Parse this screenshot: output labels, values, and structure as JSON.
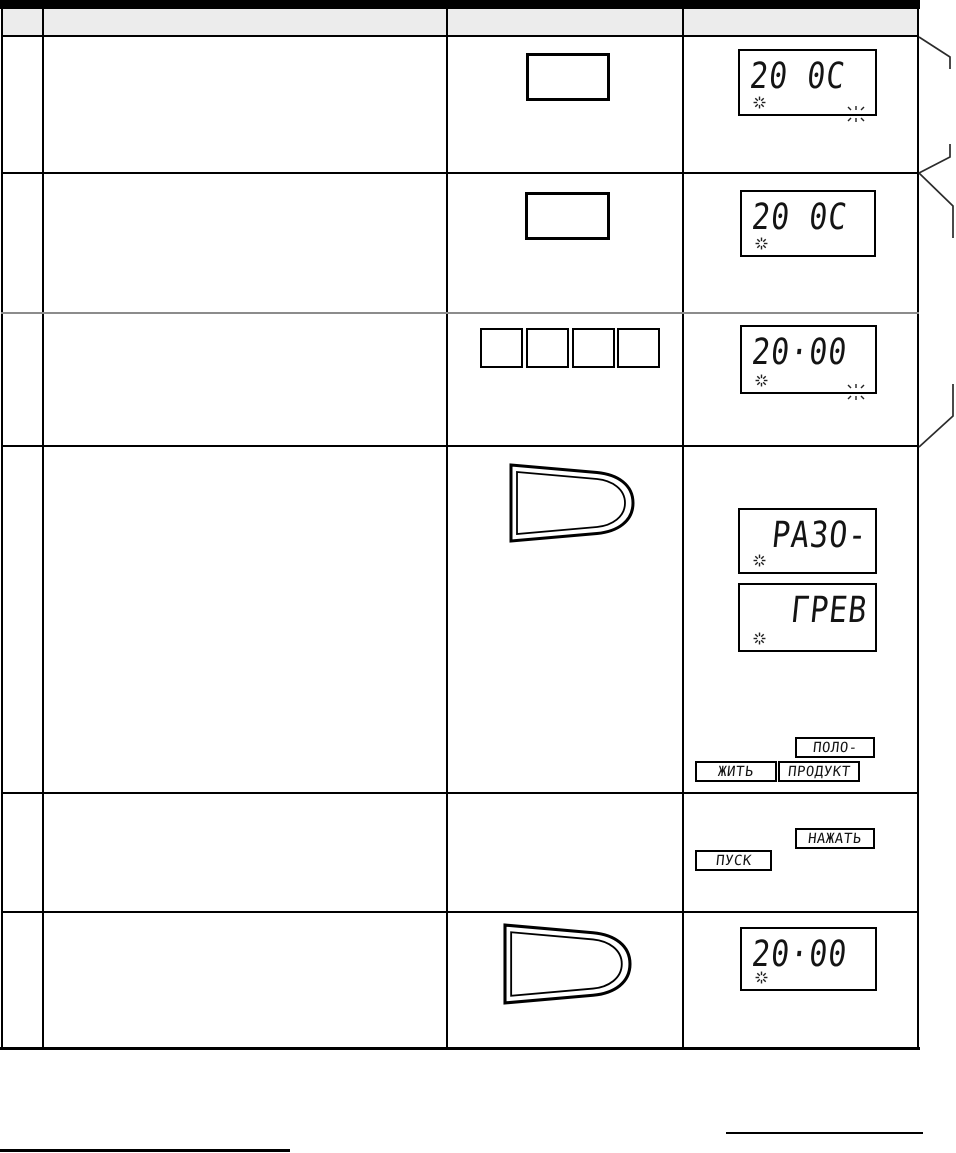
{
  "table": {
    "rows": [
      {
        "display": "20 0C"
      },
      {
        "display": "20 0C"
      },
      {
        "display": "20·00"
      },
      {
        "display_line1": "РАЗО-",
        "display_line2": "ГРЕВ",
        "messages": [
          "ПОЛО-",
          "ЖИТЬ",
          "ПРОДУКТ"
        ]
      },
      {
        "messages": [
          "НАЖАТЬ",
          "ПУСК"
        ]
      },
      {
        "display": "20·00"
      }
    ]
  },
  "icons": {
    "fan_indicator": "✳",
    "blink_marks": "\\|/ ticks at display edge"
  },
  "colors": {
    "line": "#000000",
    "gray_row_line": "#8c8c8c",
    "header_fill": "#ececec",
    "lcd_text": "#141414"
  }
}
